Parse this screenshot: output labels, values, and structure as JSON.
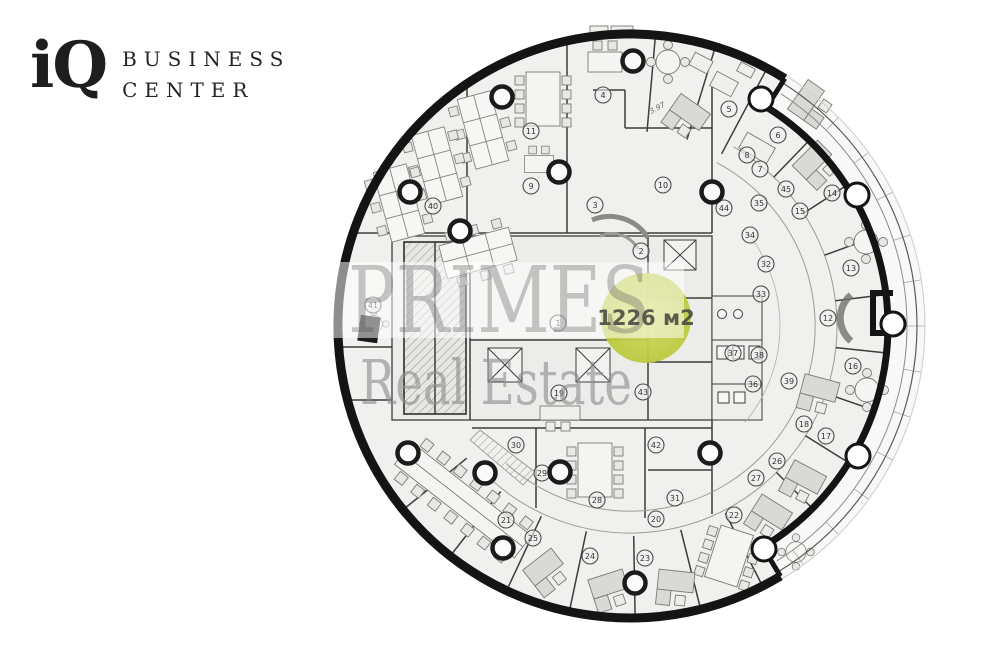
{
  "logo": {
    "mark": "iQ",
    "line1": "BUSINESS",
    "line2": "CENTER"
  },
  "watermark": {
    "line1": "PRIMES",
    "line2": "Real Estate"
  },
  "area_badge": {
    "label": "1226 м2",
    "color_center": "#cbd75c",
    "color_edge": "#bcca3e",
    "text_color": "#4b4b43"
  },
  "dimensions": {
    "diag": "3.97"
  },
  "plan": {
    "floor_color": "#f0f0ef",
    "wall_color": "#141414",
    "rooms": [
      {
        "n": "1",
        "x": 558,
        "y": 323
      },
      {
        "n": "2",
        "x": 641,
        "y": 251
      },
      {
        "n": "3",
        "x": 595,
        "y": 205
      },
      {
        "n": "4",
        "x": 603,
        "y": 95
      },
      {
        "n": "5",
        "x": 729,
        "y": 109
      },
      {
        "n": "6",
        "x": 778,
        "y": 135
      },
      {
        "n": "7",
        "x": 760,
        "y": 169
      },
      {
        "n": "8",
        "x": 747,
        "y": 155
      },
      {
        "n": "9",
        "x": 531,
        "y": 186
      },
      {
        "n": "10",
        "x": 663,
        "y": 185
      },
      {
        "n": "11",
        "x": 531,
        "y": 131
      },
      {
        "n": "12",
        "x": 828,
        "y": 318
      },
      {
        "n": "13",
        "x": 851,
        "y": 268
      },
      {
        "n": "14",
        "x": 832,
        "y": 193
      },
      {
        "n": "15",
        "x": 800,
        "y": 211
      },
      {
        "n": "16",
        "x": 853,
        "y": 366
      },
      {
        "n": "17",
        "x": 826,
        "y": 436
      },
      {
        "n": "18",
        "x": 804,
        "y": 424
      },
      {
        "n": "19",
        "x": 559,
        "y": 393
      },
      {
        "n": "20",
        "x": 656,
        "y": 519
      },
      {
        "n": "21",
        "x": 506,
        "y": 520
      },
      {
        "n": "22",
        "x": 734,
        "y": 515
      },
      {
        "n": "23",
        "x": 645,
        "y": 558
      },
      {
        "n": "24",
        "x": 590,
        "y": 556
      },
      {
        "n": "25",
        "x": 533,
        "y": 538
      },
      {
        "n": "26",
        "x": 777,
        "y": 461
      },
      {
        "n": "27",
        "x": 756,
        "y": 478
      },
      {
        "n": "28",
        "x": 597,
        "y": 500
      },
      {
        "n": "29",
        "x": 542,
        "y": 473
      },
      {
        "n": "30",
        "x": 516,
        "y": 445
      },
      {
        "n": "31",
        "x": 675,
        "y": 498
      },
      {
        "n": "32",
        "x": 766,
        "y": 264
      },
      {
        "n": "33",
        "x": 761,
        "y": 294
      },
      {
        "n": "34",
        "x": 750,
        "y": 235
      },
      {
        "n": "35",
        "x": 759,
        "y": 203
      },
      {
        "n": "36",
        "x": 753,
        "y": 384
      },
      {
        "n": "37",
        "x": 733,
        "y": 353
      },
      {
        "n": "38",
        "x": 759,
        "y": 355
      },
      {
        "n": "39",
        "x": 789,
        "y": 381
      },
      {
        "n": "40",
        "x": 433,
        "y": 206
      },
      {
        "n": "41",
        "x": 373,
        "y": 305
      },
      {
        "n": "42",
        "x": 656,
        "y": 445
      },
      {
        "n": "43",
        "x": 643,
        "y": 392
      },
      {
        "n": "44",
        "x": 724,
        "y": 208
      },
      {
        "n": "45",
        "x": 786,
        "y": 189
      }
    ],
    "columns": [
      [
        502,
        97
      ],
      [
        633,
        61
      ],
      [
        460,
        231
      ],
      [
        410,
        192
      ],
      [
        559,
        172
      ],
      [
        712,
        192
      ],
      [
        408,
        453
      ],
      [
        485,
        473
      ],
      [
        560,
        472
      ],
      [
        503,
        548
      ],
      [
        635,
        583
      ],
      [
        710,
        453
      ]
    ],
    "wall_columns": [
      [
        761,
        99
      ],
      [
        857,
        195
      ],
      [
        893,
        324
      ],
      [
        858,
        456
      ],
      [
        764,
        549
      ]
    ]
  }
}
